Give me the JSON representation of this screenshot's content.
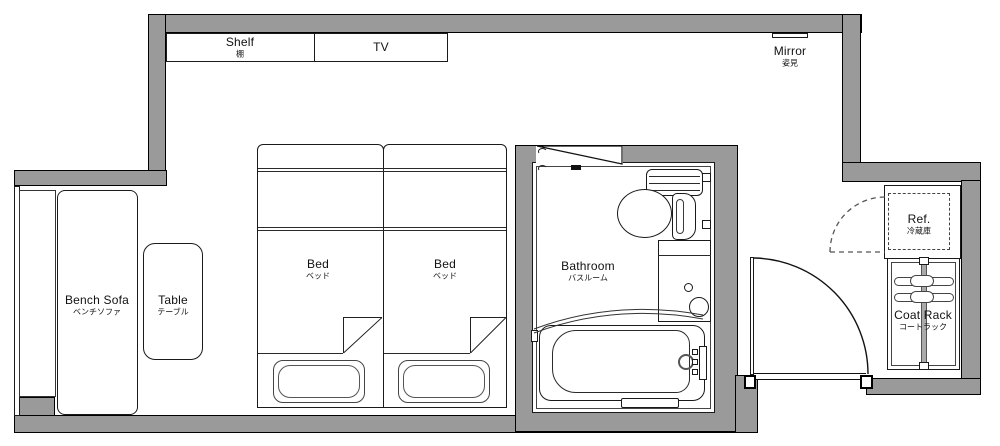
{
  "title": "Hotel twin room floor plan",
  "colors": {
    "wall": "#9a9a9a",
    "line": "#1a1a1a",
    "floor": "#ffffff"
  },
  "labels": {
    "shelf": {
      "en": "Shelf",
      "ja": "棚"
    },
    "tv": {
      "en": "TV"
    },
    "mirror": {
      "en": "Mirror",
      "ja": "姿見"
    },
    "bench_sofa": {
      "en": "Bench Sofa",
      "ja": "ベンチソファ"
    },
    "table": {
      "en": "Table",
      "ja": "テーブル"
    },
    "bed_left": {
      "en": "Bed",
      "ja": "ベッド"
    },
    "bed_right": {
      "en": "Bed",
      "ja": "ベッド"
    },
    "bathroom": {
      "en": "Bathroom",
      "ja": "バスルーム"
    },
    "refrigerator": {
      "en": "Ref.",
      "ja": "冷蔵庫"
    },
    "coat_rack": {
      "en": "Coat Rack",
      "ja": "コートラック"
    }
  }
}
